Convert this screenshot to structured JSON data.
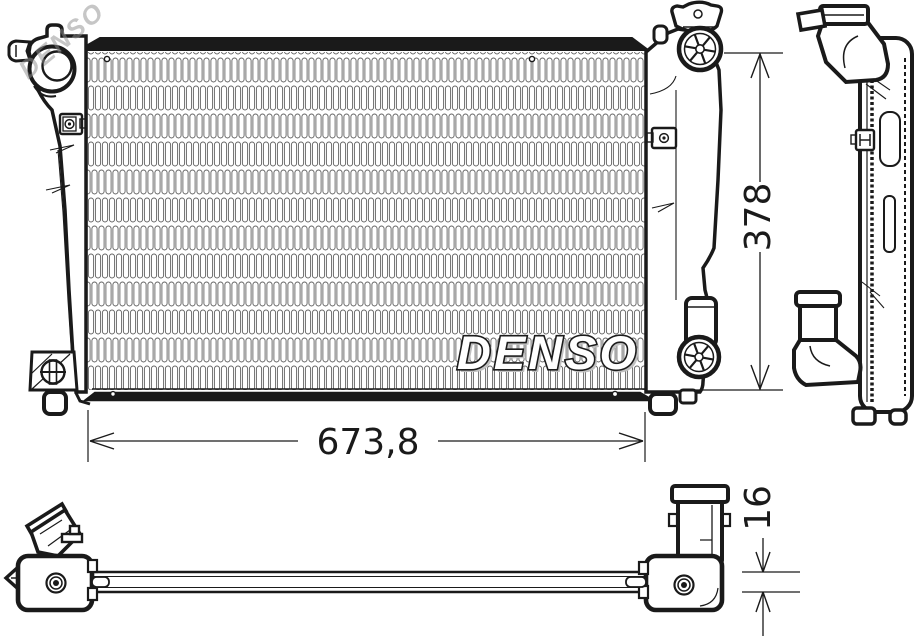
{
  "logo": {
    "text": "DENSO"
  },
  "watermark": {
    "text": "DENSO"
  },
  "dimensions": {
    "width": "673,8",
    "height": "378",
    "depth": "16"
  },
  "colors": {
    "line": "#1a1a1a",
    "fins": "#606060",
    "watermark_grey": "#c8c8c8",
    "logo_fill": "#ffffff",
    "background": "#ffffff"
  }
}
